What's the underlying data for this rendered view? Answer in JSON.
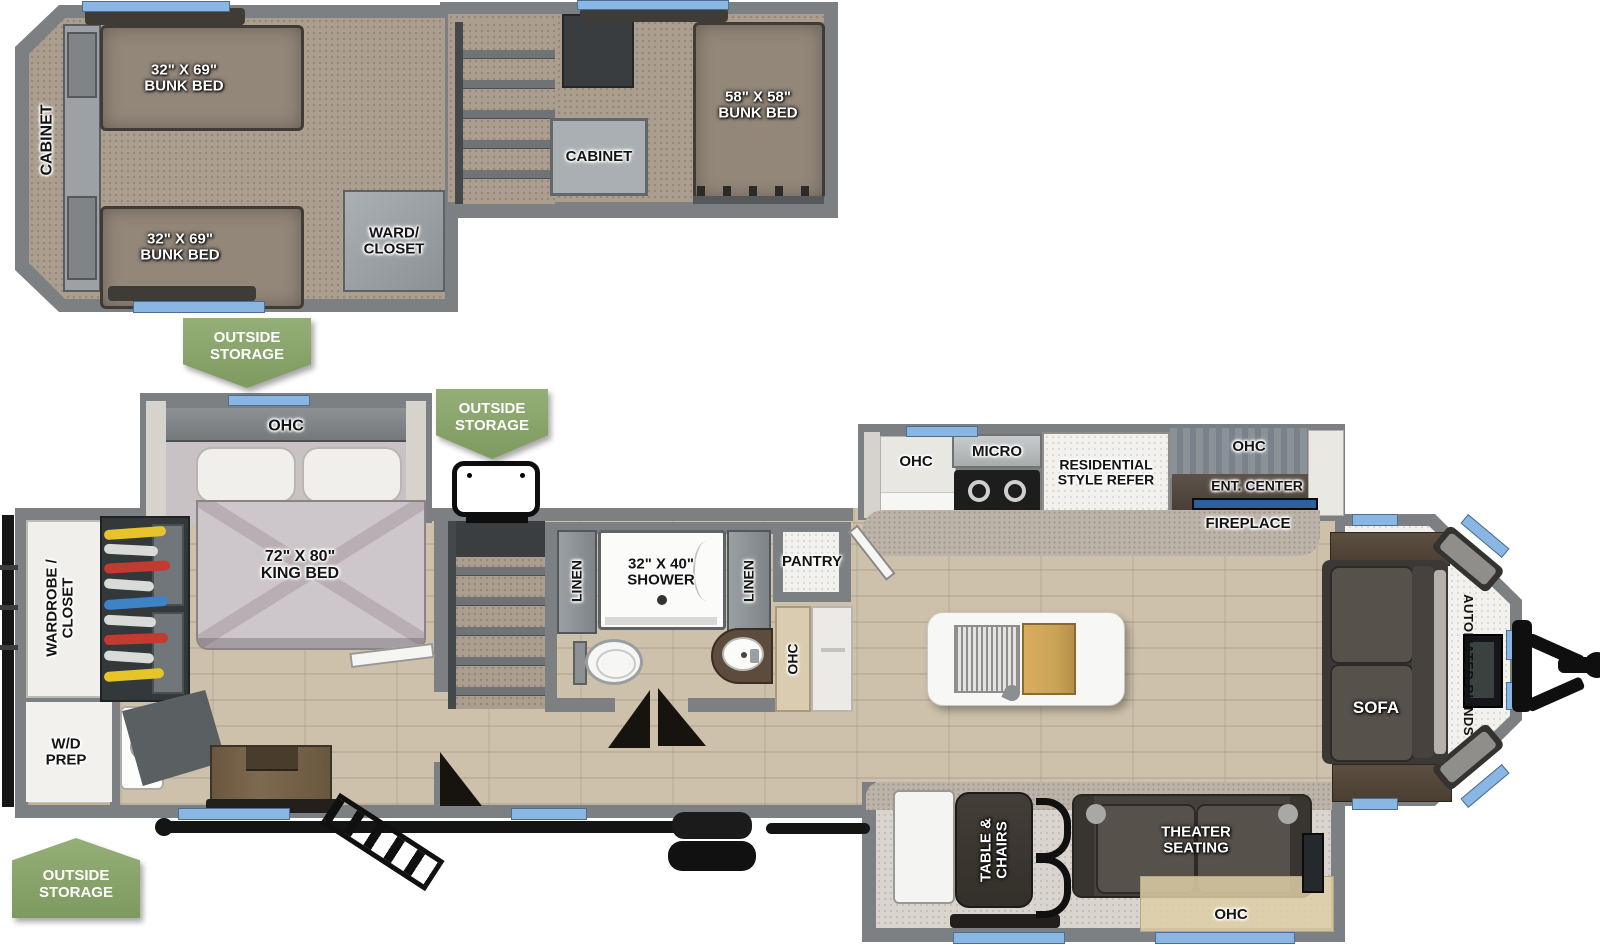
{
  "meta": {
    "title": "RV travel trailer floor plan with loft"
  },
  "colors": {
    "badge_green": "#89a46c",
    "window_blue": "#8ab6e4",
    "wall_gray": "#7c8082",
    "wood_floor": "#cdc1ab",
    "carpet_tan": "#ab9e8f",
    "furniture_dark": "#45403b"
  },
  "loft": {
    "cabinet": "CABINET",
    "bunk_top": "32\" X 69\" BUNK BED",
    "bunk_bottom": "32\" X 69\" BUNK BED",
    "ward_closet": "WARD/ CLOSET",
    "stair_cabinet": "CABINET",
    "bunk_rear": "58\" X 58\" BUNK BED"
  },
  "badges": {
    "outside_storage": "OUTSIDE STORAGE"
  },
  "bedroom": {
    "ohc": "OHC",
    "king_bed": "72\" X 80\" KING BED",
    "wardrobe": "WARDROBE / CLOSET",
    "wd_prep": "W/D PREP"
  },
  "bath": {
    "linen": "LINEN",
    "shower": "32\" X 40\" SHOWER",
    "pantry": "PANTRY",
    "ohc": "OHC"
  },
  "kitchen": {
    "ohc": "OHC",
    "micro": "MICRO",
    "refer": "RESIDENTIAL STYLE REFER",
    "ent_ohc": "OHC",
    "ent_center": "ENT. CENTER",
    "fireplace": "FIREPLACE"
  },
  "living": {
    "sofa": "SOFA",
    "automated_blinds": "AUTOMATED BLINDS"
  },
  "dinette": {
    "table_chairs": "TABLE & CHAIRS",
    "theater": "THEATER SEATING",
    "ohc": "OHC"
  }
}
